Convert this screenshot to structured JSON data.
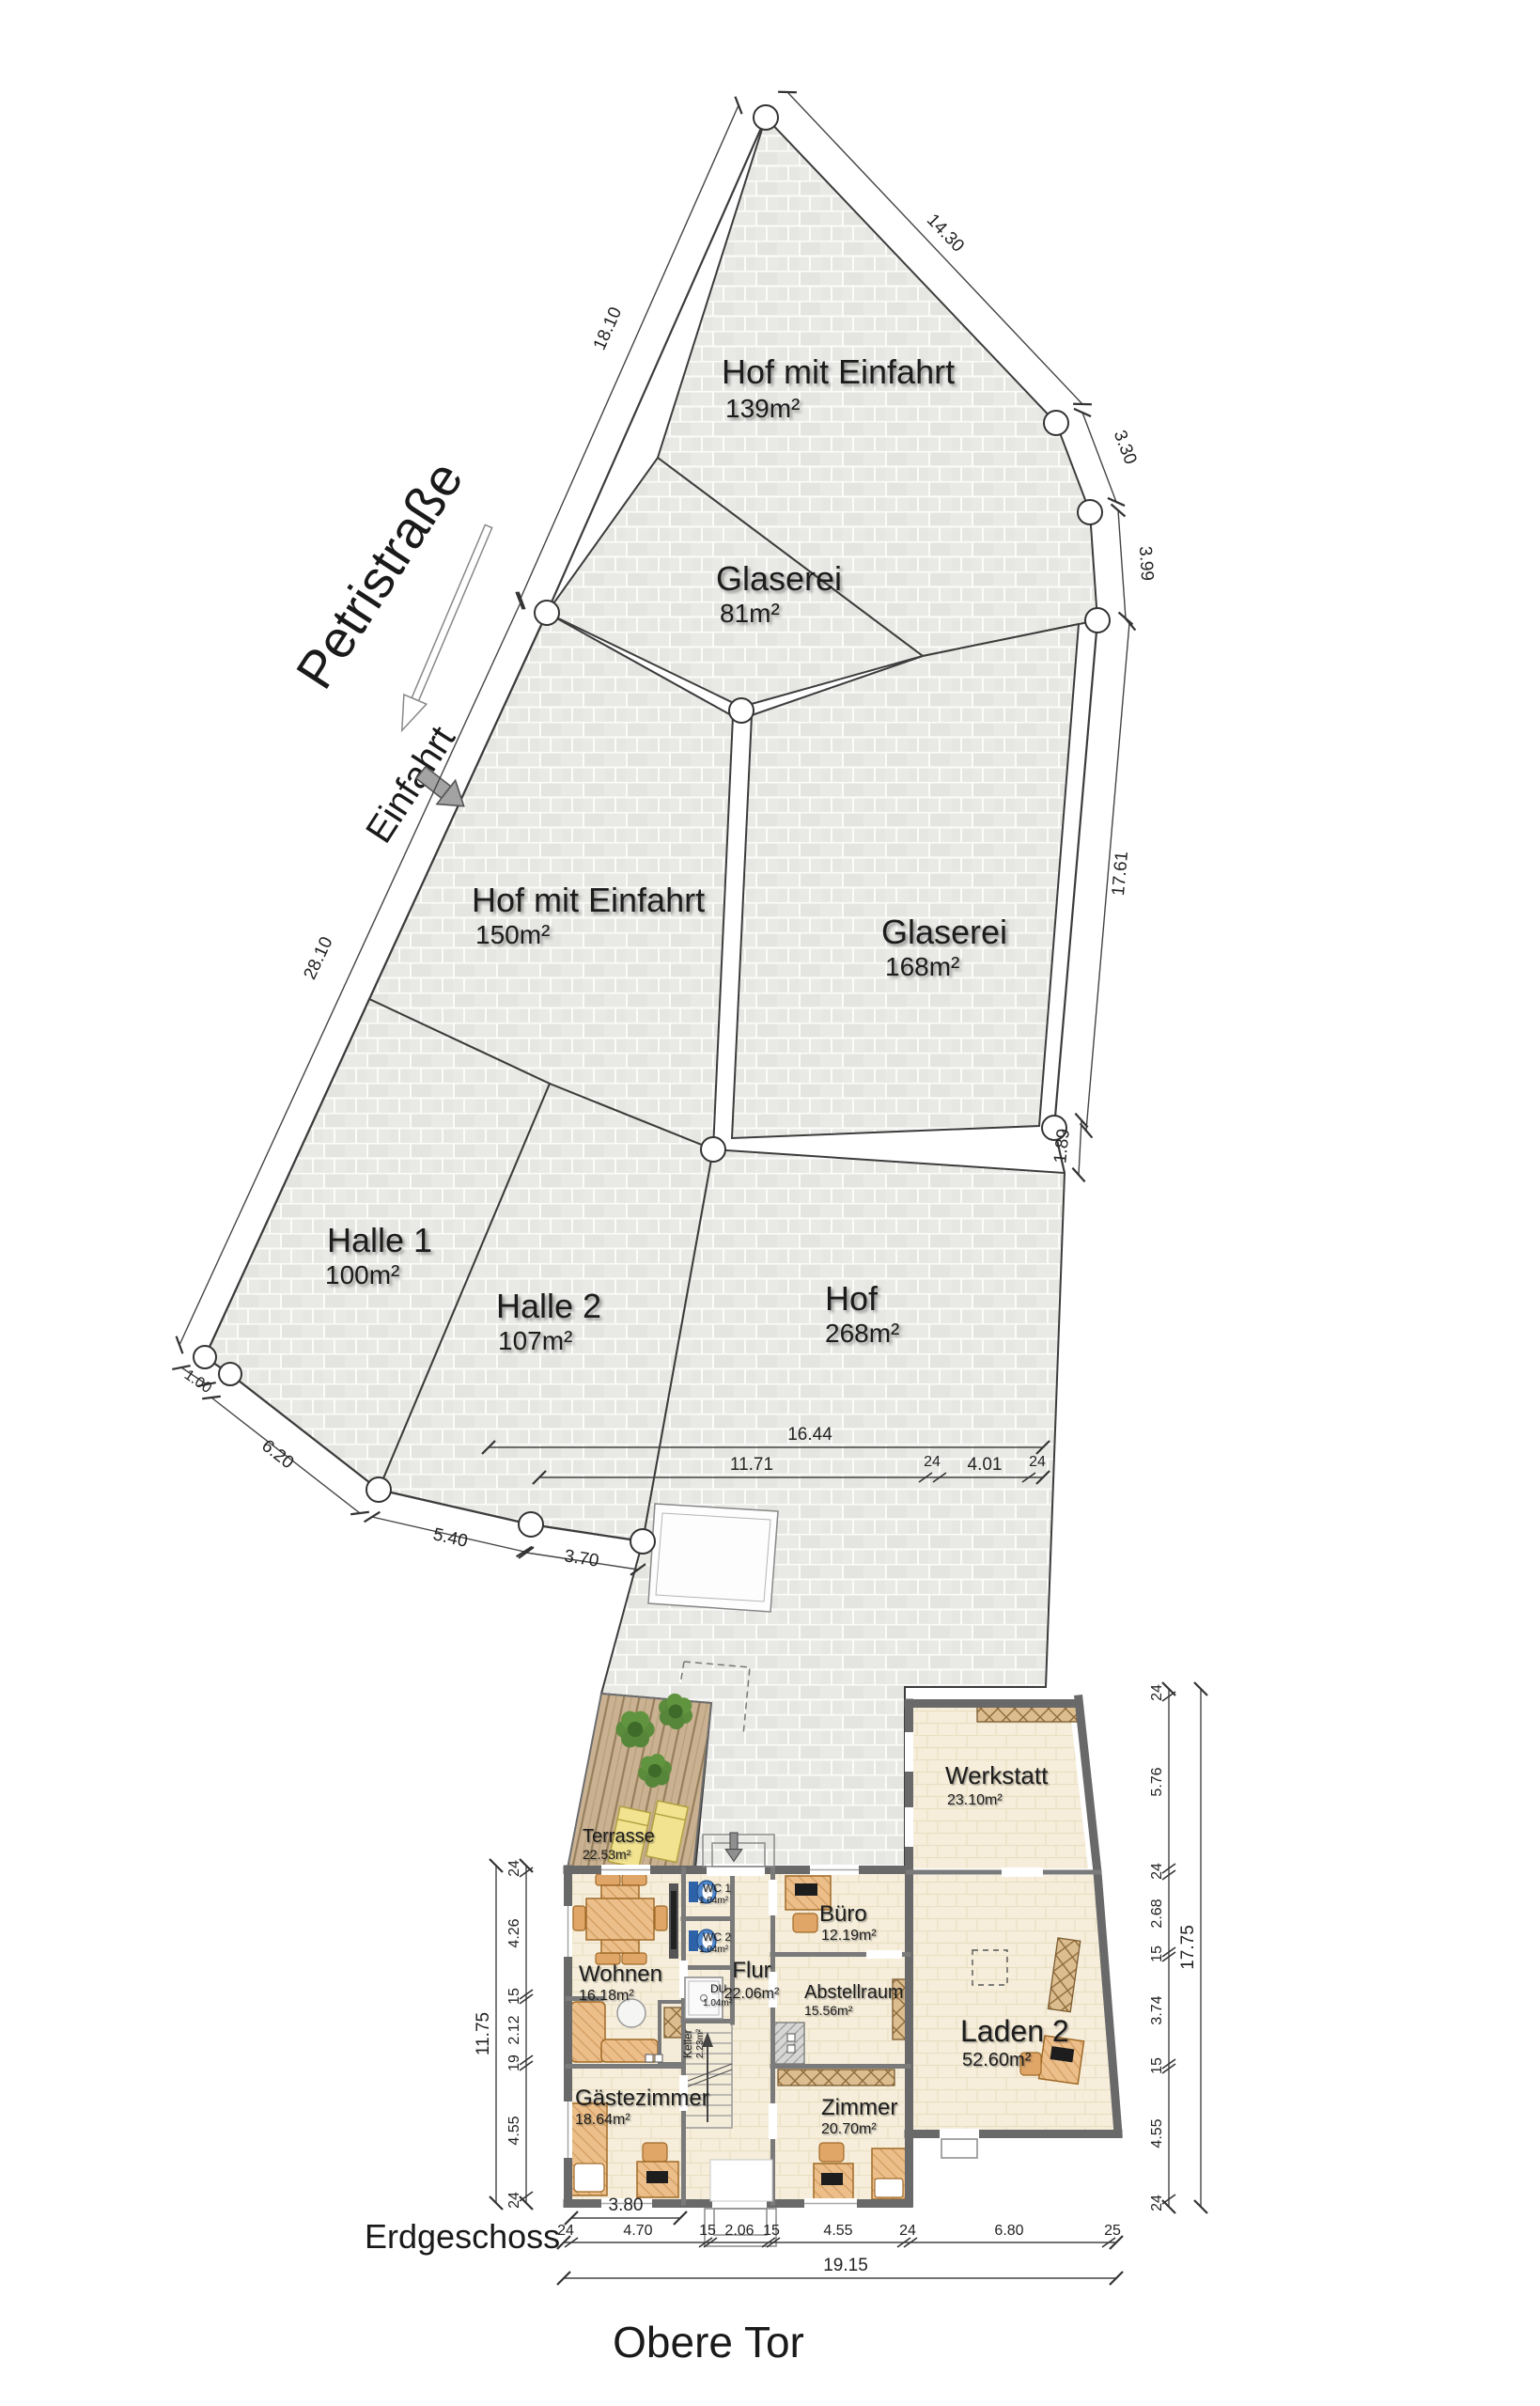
{
  "floor_plan": {
    "title": "Obere Tor",
    "floor_label": "Erdgeschoss",
    "street": {
      "name": "Petristraße",
      "entrance_label": "Einfahrt"
    },
    "parcels": [
      {
        "name": "Hof mit Einfahrt",
        "area": "139m²"
      },
      {
        "name": "Glaserei",
        "area": "81m²"
      },
      {
        "name": "Hof mit Einfahrt",
        "area": "150m²"
      },
      {
        "name": "Glaserei",
        "area": "168m²"
      },
      {
        "name": "Halle 1",
        "area": "100m²"
      },
      {
        "name": "Halle 2",
        "area": "107m²"
      },
      {
        "name": "Hof",
        "area": "268m²"
      }
    ],
    "rooms": [
      {
        "name": "Terrasse",
        "area": "22.53m²"
      },
      {
        "name": "Werkstatt",
        "area": "23.10m²"
      },
      {
        "name": "Büro",
        "area": "12.19m²"
      },
      {
        "name": "Wohnen",
        "area": "16.18m²"
      },
      {
        "name": "Flur",
        "area": "22.06m²"
      },
      {
        "name": "Abstellraum",
        "area": "15.56m²"
      },
      {
        "name": "Laden 2",
        "area": "52.60m²"
      },
      {
        "name": "Gästezimmer",
        "area": "18.64m²"
      },
      {
        "name": "Zimmer",
        "area": "20.70m²"
      },
      {
        "name": "WC 1",
        "area": "1.04m²"
      },
      {
        "name": "WC 2",
        "area": "1.04m²"
      },
      {
        "name": "DU",
        "area": "1.04m²"
      },
      {
        "name": "Keller",
        "area": "2.23m²"
      }
    ],
    "site_dims": {
      "left_upper": "18.10",
      "left_lower": "28.10",
      "top_right": "14.30",
      "right_1": "3.30",
      "right_2": "3.99",
      "right_3": "17.61",
      "right_4": "1.89",
      "corner": "1.00",
      "south_1": "6.20",
      "south_2": "5.40",
      "south_3": "3.70",
      "hof_width": "16.44",
      "hof_row": [
        "11.71",
        "24",
        "4.01",
        "24"
      ]
    },
    "building_dims": {
      "left": {
        "overall": "11.75",
        "segments": [
          "24",
          "4.26",
          "15",
          "2.12",
          "19",
          "4.55",
          "24"
        ]
      },
      "right": {
        "overall": "17.75",
        "segments": [
          "24",
          "5.76",
          "24",
          "2.68",
          "15",
          "3.74",
          "15",
          "4.55",
          "24"
        ]
      },
      "bottom": {
        "row1": "3.80",
        "row2": [
          "24",
          "4.70",
          "15",
          "2.06",
          "15",
          "4.55",
          "24",
          "6.80",
          "25"
        ],
        "row3": "19.15"
      }
    },
    "colors": {
      "paving": "#e9e9e6",
      "room": "#f6eedb",
      "wood": "#c9b191",
      "furniture": "#ecbf8a",
      "wall": "#6e6e6e",
      "wc_fixture": "#4f87cc",
      "plant": "#5a8c3c",
      "lounger": "#f1e390"
    }
  }
}
